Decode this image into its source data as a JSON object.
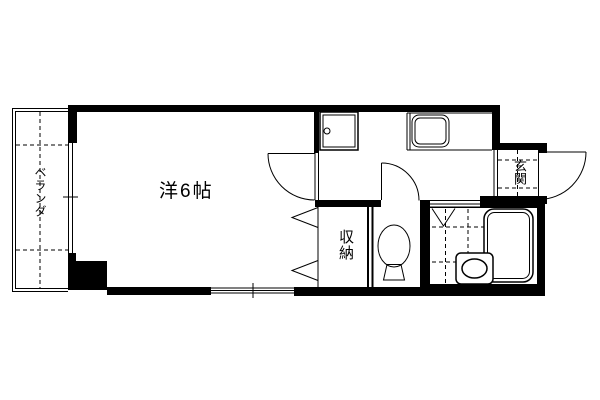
{
  "figure": {
    "type": "apartment-floor-plan",
    "background_color": "#ffffff",
    "line_color": "#000000"
  },
  "labels": {
    "veranda": "ベランダ",
    "main_room": "洋6帖",
    "storage": "収納",
    "entrance": "玄関"
  },
  "icons": {
    "washing_machine": "washing-machine-pan-icon",
    "kitchen_sink": "kitchen-sink-icon",
    "toilet": "toilet-icon",
    "bathtub": "bathtub-icon",
    "washbasin": "washbasin-icon",
    "swing_door": "door-swing-arc-icon",
    "folding_door": "folding-door-icon",
    "sliding_window": "sliding-window-icon"
  }
}
